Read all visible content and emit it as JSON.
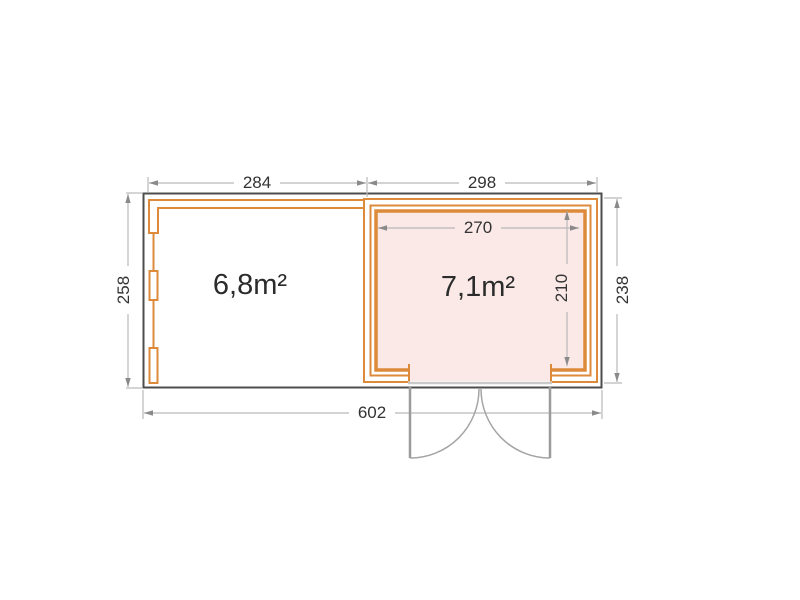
{
  "plan": {
    "left_area_label": "6,8m²",
    "right_area_label": "7,1m²",
    "dim_top_left": "284",
    "dim_top_right": "298",
    "dim_inner_width": "270",
    "dim_left_depth": "258",
    "dim_right_depth": "238",
    "dim_inner_depth": "210",
    "dim_total_width": "602",
    "colors": {
      "wall": "#dd8a3a",
      "room_fill": "#fbe9e7",
      "outline": "#4d4d4d",
      "dim_line": "#b9b9b9",
      "dim_text": "#333333",
      "door": "#9b9b9b",
      "label": "#2b2b2b"
    }
  }
}
